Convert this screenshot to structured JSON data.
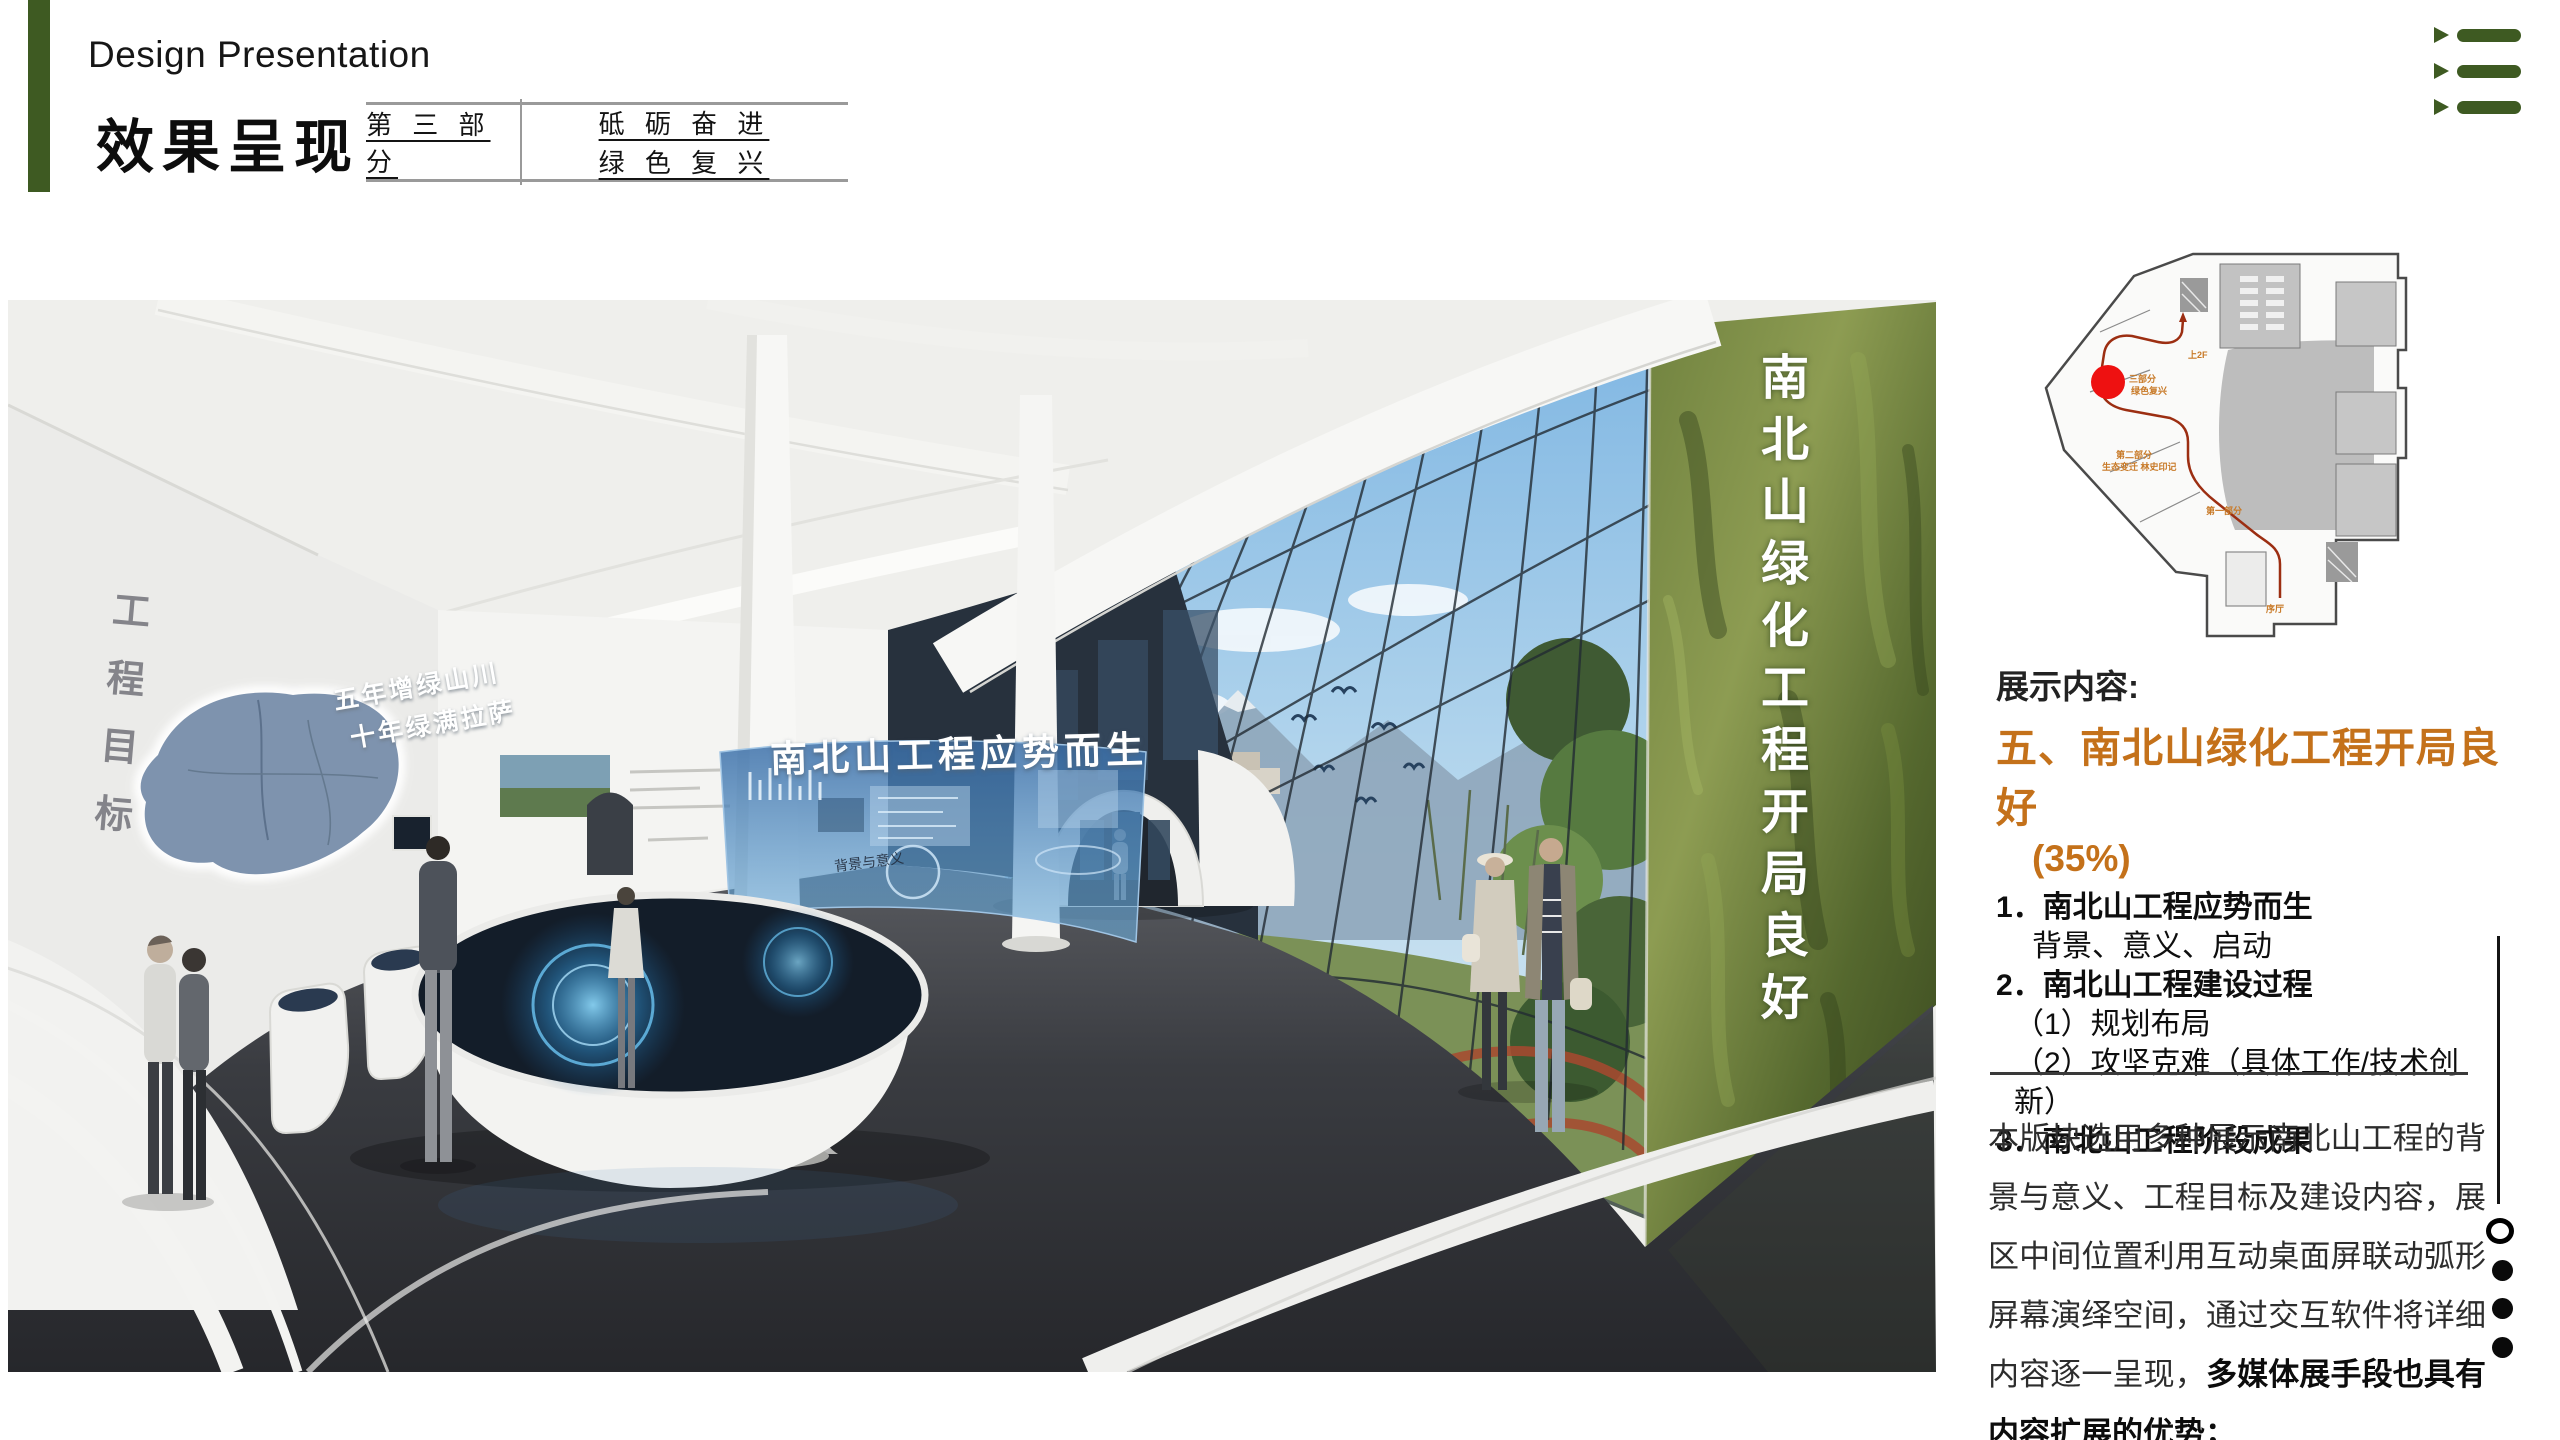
{
  "header": {
    "en_title": "Design Presentation",
    "zh_title": "效果呈现",
    "part_label": "第 三 部 分",
    "motto_line1": "砥 砺 奋 进",
    "motto_line2": "绿 色 复 兴"
  },
  "hall_render": {
    "green_wall_text": "南北山绿化工程开局良好",
    "left_wall_text": "工程目标",
    "map_slogan_line1": "五年增绿山川",
    "map_slogan_line2": "十年绿满拉萨",
    "screen_title": "南北山工程应势而生",
    "screen_sublabel": "背景与意义"
  },
  "floor_plan": {
    "label_up": "上2F",
    "label_part3_line1": "三部分",
    "label_part3_line2": "绿色复兴",
    "label_part2_line1": "第二部分",
    "label_part2_line2": "生态变迁 林史印记",
    "label_part1": "第一部分",
    "label_lobby": "序厅"
  },
  "content": {
    "heading": "展示内容:",
    "section_title": "五、南北山绿化工程开局良好",
    "percent": "(35%)",
    "items": [
      "1．南北山工程应势而生",
      "背景、意义、启动",
      "2．南北山工程建设过程",
      "（1）规划布局",
      "（2）攻坚克难（具体工作/技术创新）",
      "3．南北山工程阶段成果"
    ],
    "paragraph_normal": "本版块选用多种展示南北山工程的背景与意义、工程目标及建设内容，展区中间位置利用互动桌面屏联动弧形屏幕演绎空间，通过交互软件将详细内容逐一呈现，",
    "paragraph_bold": "多媒体展手段也具有内容扩展的优势；"
  },
  "colors": {
    "accent_green": "#3e5a22",
    "accent_orange": "#c4711a",
    "marker_red": "#ee1111",
    "route_red": "#9c2e12"
  }
}
